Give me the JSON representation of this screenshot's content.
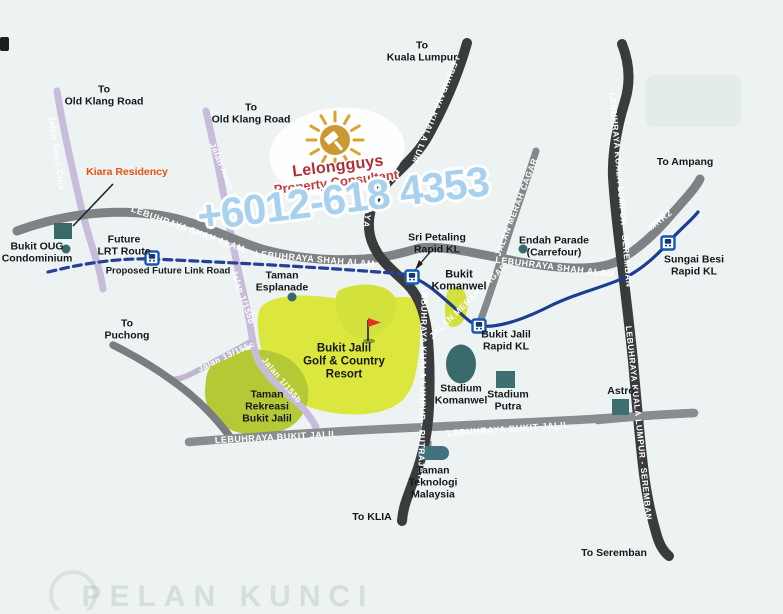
{
  "watermark": {
    "brand": "Lelongguys",
    "tagline": "Property Consultant",
    "phone": "+6012-618 4353"
  },
  "labels": {
    "d_old_klang_w": "To\nOld Klang Road",
    "d_old_klang_e": "To\nOld Klang Road",
    "d_kl": "To\nKuala Lumpur",
    "d_ampang": "To Ampang",
    "d_puchong": "To\nPuchong",
    "d_klia": "To KLIA",
    "d_seremban": "To Seremban",
    "kiara": "Kiara Residency",
    "bukit_oug": "Bukit OUG\nCondominium",
    "future_lrt": "Future\nLRT Route",
    "proposed_link": "Proposed Future Link Road",
    "esplanade": "Taman\nEsplanade",
    "sri_petaling": "Sri Petaling\nRapid KL",
    "bukit_komanwel": "Bukit\nKomanwel",
    "endah": "Endah Parade\n(Carrefour)",
    "sungai_besi": "Sungai Besi\nRapid KL",
    "bj_rapid": "Bukit Jalil\nRapid KL",
    "golf": "Bukit Jalil\nGolf & Country\nResort",
    "rekreasi": "Taman\nRekreasi\nBukit Jalil",
    "st_komanwel": "Stadium\nKomanwel",
    "st_putra": "Stadium\nPutra",
    "astro": "Astro",
    "teknologi": "Taman\nTeknologi\nMalaysia"
  },
  "road_labels": {
    "awan_cina": "Jalan Awan Cina",
    "awan_besar": "Jalan Awan Besar",
    "j1155b_a": "Jalan 1/155b",
    "j1155b_b": "Jalan 1/155b",
    "j13155c": "Jalan 13/155c",
    "shah_alam_w": "LEBUHRAYA SHAH ALAM",
    "shah_alam_c": "LEBUHRAYA SHAH ALAM",
    "shah_alam_e": "LEBUHRAYA SHAH ALAM",
    "kl_top": "LEBUHRAYA KUALA LUM",
    "ajaya": "AJAYA",
    "kl_putrajaya": "LEBUHRAYA KUALA LUMPUR - PUTRAJAYA",
    "kl_seremban_n": "LEBUHRAYA KUALA LUMPUR - SEREMBAN",
    "kl_seremban_s": "LEBUHRAYA KUALA LUMPUR - SEREMBAN",
    "mrr2": "MRR2",
    "merah_cagar_n": "JALAN MERAH CAGAR",
    "merah_cagar_s": "JALAN MERAH CAGAR",
    "bukit_jalil_w": "LEBUHRAYA BUKIT JALIL",
    "bukit_jalil_e": "LEBUHRAYA BUKIT JALIL"
  },
  "bleed": {
    "text": "PELAN KUNCI"
  },
  "colors": {
    "background": "#edf2f3",
    "road_gray": "#7f8285",
    "road_dark": "#3a3b3d",
    "road_lavender": "#c7bcd9",
    "golf_green": "#dce73e",
    "park_green": "#b5c937",
    "landmark_teal": "#38696b",
    "rail_blue": "#1c3e90",
    "station_blue": "#1558b4",
    "phone_blue": "#a8d1ef",
    "brand_red": "#b02e34",
    "highlight_orange": "#e8500e",
    "sun_gold": "#d3992c"
  }
}
